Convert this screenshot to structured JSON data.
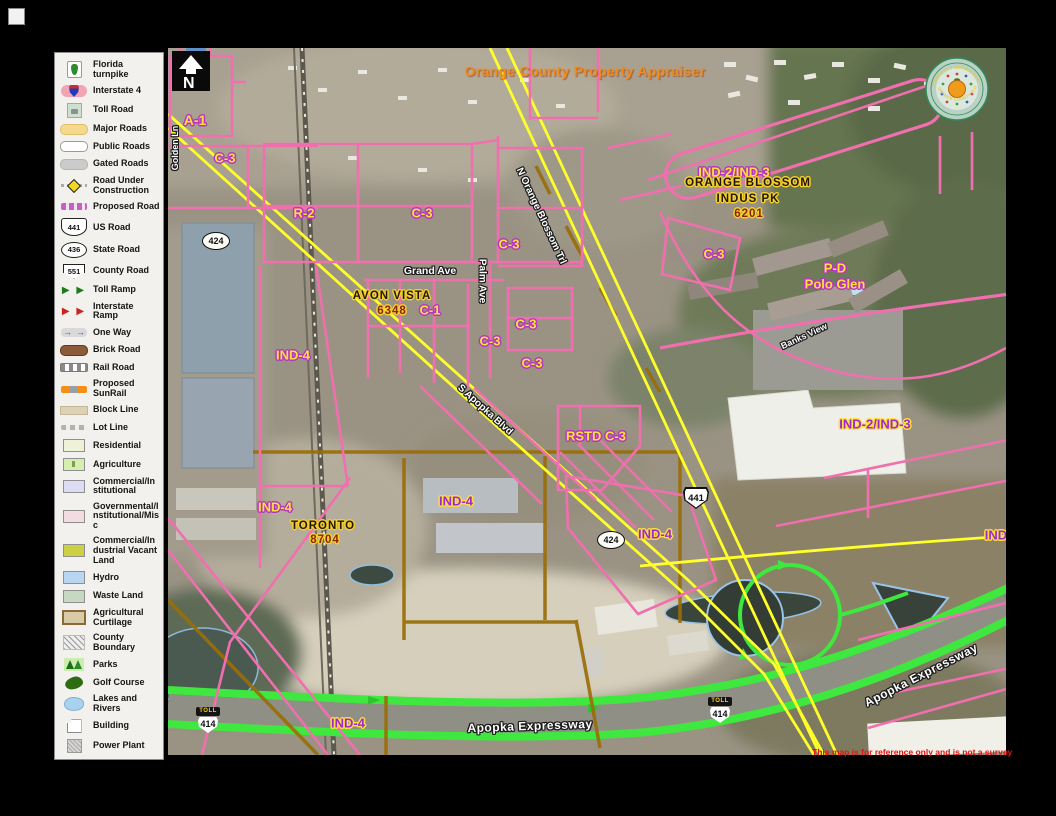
{
  "legend": {
    "items": [
      {
        "label": "Florida turnpike"
      },
      {
        "label": "Interstate 4"
      },
      {
        "label": "Toll Road"
      },
      {
        "label": "Major Roads"
      },
      {
        "label": "Public Roads"
      },
      {
        "label": "Gated Roads"
      },
      {
        "label": "Road Under Construction"
      },
      {
        "label": "Proposed Road"
      },
      {
        "label": "US Road",
        "icon_text": "441"
      },
      {
        "label": "State Road",
        "icon_text": "436"
      },
      {
        "label": "County Road",
        "icon_text": "551"
      },
      {
        "label": "Toll Ramp"
      },
      {
        "label": "Interstate Ramp"
      },
      {
        "label": "One Way"
      },
      {
        "label": "Brick Road"
      },
      {
        "label": "Rail Road"
      },
      {
        "label": "Proposed SunRail"
      },
      {
        "label": "Block Line"
      },
      {
        "label": "Lot Line"
      },
      {
        "label": "Residential"
      },
      {
        "label": "Agriculture"
      },
      {
        "label": "Commercial/Institutional"
      },
      {
        "label": "Governmental/Institutional/Misc"
      },
      {
        "label": "Commercial/Industrial Vacant Land"
      },
      {
        "label": "Hydro"
      },
      {
        "label": "Waste Land"
      },
      {
        "label": "Agricultural Curtilage"
      },
      {
        "label": "County Boundary"
      },
      {
        "label": "Parks"
      },
      {
        "label": "Golf Course"
      },
      {
        "label": "Lakes and Rivers"
      },
      {
        "label": "Building"
      },
      {
        "label": "Power Plant"
      }
    ]
  },
  "map": {
    "title": "Orange County Property Appraiser",
    "compass_label": "N",
    "seal": {
      "arc_top": "PROPERTY APPRAISER",
      "arc_bottom": "ORANGE COUNTY FLORIDA"
    },
    "zoning_labels": [
      {
        "text": "A-1"
      },
      {
        "text": "C-3"
      },
      {
        "text": "R-2"
      },
      {
        "text": "C-3"
      },
      {
        "text": "C-3"
      },
      {
        "text": "C-3"
      },
      {
        "text": "C-1"
      },
      {
        "text": "C-3"
      },
      {
        "text": "C-3"
      },
      {
        "text": "C-3"
      },
      {
        "text": "IND-4"
      },
      {
        "text": "IND-2/IND-3"
      },
      {
        "text": "P-D"
      },
      {
        "text": "Polo Glen"
      },
      {
        "text": "RSTD C-3"
      },
      {
        "text": "IND-4"
      },
      {
        "text": "IND-4"
      },
      {
        "text": "IND-4"
      },
      {
        "text": "IND-2/IND-3"
      },
      {
        "text": "IND-4"
      },
      {
        "text": "IND"
      }
    ],
    "subdivision_labels": [
      {
        "text": "AVON VISTA"
      },
      {
        "text": "6348"
      },
      {
        "text": "ORANGE BLOSSOM"
      },
      {
        "text": "INDUS PK"
      },
      {
        "text": "6201"
      },
      {
        "text": "TORONTO"
      },
      {
        "text": "8704"
      }
    ],
    "street_labels": [
      {
        "text": "Grand Ave"
      },
      {
        "text": "Palm Ave"
      },
      {
        "text": "N Orange Blossom Trl"
      },
      {
        "text": "S Apopka Blvd"
      },
      {
        "text": "Banks View"
      },
      {
        "text": "Apopka Expressway"
      },
      {
        "text": "Apopka Expressway"
      },
      {
        "text": "Golden Ln"
      }
    ],
    "shields": [
      {
        "type": "county",
        "text": "424"
      },
      {
        "type": "us",
        "text": "441"
      },
      {
        "type": "county",
        "text": "424"
      },
      {
        "type": "toll",
        "banner": "TOLL",
        "text": "414"
      },
      {
        "type": "toll",
        "banner": "TOLL",
        "text": "414"
      }
    ],
    "disclaimer": "This map is for reference only and is not a survey"
  },
  "colors": {
    "parcel_pink": "#f06fae",
    "road_yellow": "#ffff29",
    "toll_green": "#3fe83f",
    "block_brown": "#9a6e08",
    "zone_label_yellow": "#ffdf3a",
    "zone_label_purple": "#a02ad2",
    "title_orange": "#ef8c1e",
    "disclaimer_red": "#e81010"
  }
}
